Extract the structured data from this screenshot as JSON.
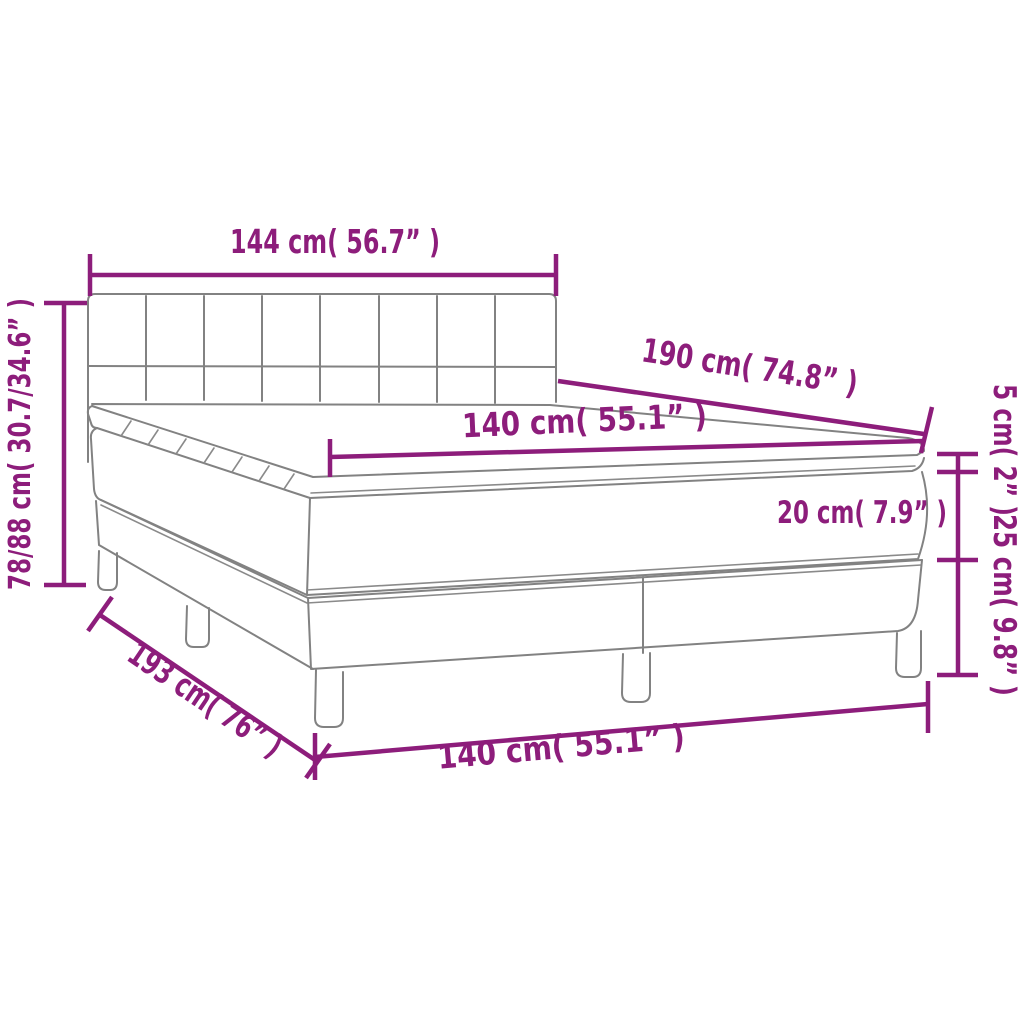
{
  "diagram": {
    "title": "box-spring-bed-dimension-diagram",
    "colors": {
      "dimension": "#8D1D7B",
      "artwork": "#828282",
      "background": "#FFFFFF"
    },
    "dimensions": {
      "headboard_width": {
        "label": "144 cm( 56.7” )",
        "cm": "144",
        "inches": "56.7"
      },
      "total_height": {
        "label": "78/88 cm( 30.7/34.6” )",
        "cm": "78/88",
        "inches": "30.7/34.6"
      },
      "bed_length": {
        "label": "190 cm( 74.8” )",
        "cm": "190",
        "inches": "74.8"
      },
      "mattress_width": {
        "label": "140 cm( 55.1” )",
        "cm": "140",
        "inches": "55.1"
      },
      "topper_height": {
        "label": "5 cm( 2” )",
        "cm": "5",
        "inches": "2"
      },
      "mattress_height": {
        "label": "20 cm( 7.9” )",
        "cm": "20",
        "inches": "7.9"
      },
      "base_height": {
        "label": "25 cm( 9.8” )",
        "cm": "25",
        "inches": "9.8"
      },
      "base_length": {
        "label": "193 cm( 76” )",
        "cm": "193",
        "inches": "76"
      },
      "base_width_bottom": {
        "label": "140 cm( 55.1” )",
        "cm": "140",
        "inches": "55.1"
      }
    }
  }
}
